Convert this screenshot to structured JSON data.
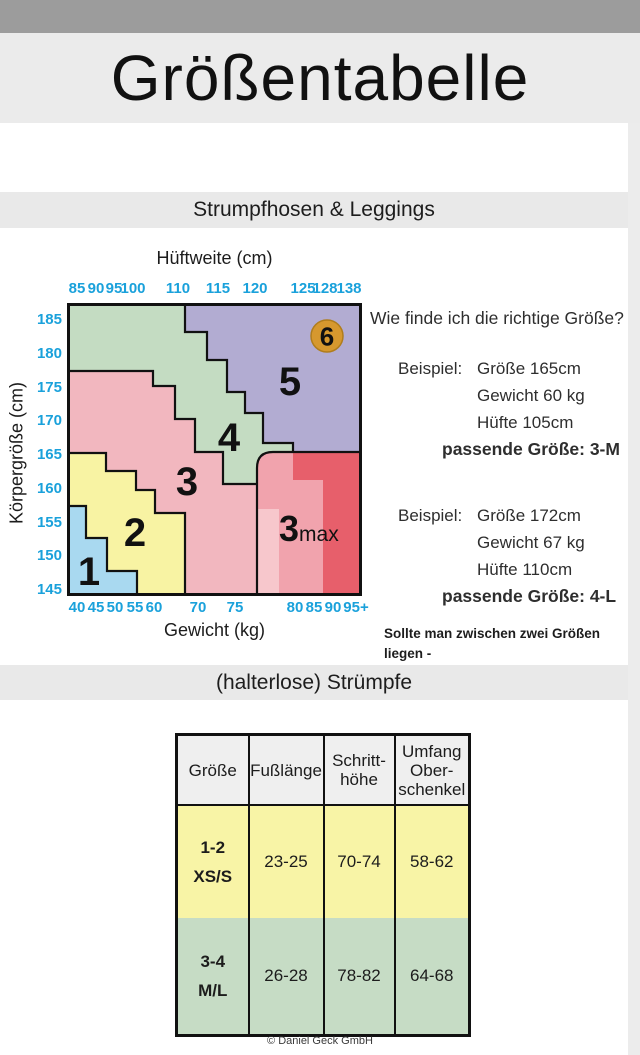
{
  "page": {
    "title": "Größentabelle",
    "footer": "© Daniel Geck GmbH"
  },
  "sections": {
    "tights": "Strumpfhosen & Leggings",
    "stockings": "(halterlose) Strümpfe"
  },
  "help": {
    "question": "Wie finde ich die richtige Größe?",
    "examples": [
      {
        "label": "Beispiel:",
        "lines": [
          "Größe 165cm",
          "Gewicht 60 kg",
          "Hüfte 105cm"
        ],
        "result": "passende Größe: 3-M"
      },
      {
        "label": "Beispiel:",
        "lines": [
          "Größe 172cm",
          "Gewicht 67 kg",
          "Hüfte 110cm"
        ],
        "result": "passende Größe: 4-L"
      }
    ],
    "note": "Sollte man zwischen zwei Größen liegen -\nimmer die nächstgrößere Größe wählen."
  },
  "chart_data": {
    "type": "heatmap",
    "title": "Strumpfhosen & Leggings Größenfinder",
    "x_top": {
      "label": "Hüftweite (cm)",
      "ticks": [
        "85",
        "90",
        "95",
        "100",
        "110",
        "115",
        "120",
        "125",
        "128",
        "138"
      ]
    },
    "x_bottom": {
      "label": "Gewicht (kg)",
      "ticks": [
        "40",
        "45",
        "50",
        "55",
        "60",
        "70",
        "75",
        "80",
        "85",
        "90",
        "95+"
      ]
    },
    "y": {
      "label": "Körpergröße (cm)",
      "ticks": [
        "185",
        "180",
        "175",
        "170",
        "165",
        "160",
        "155",
        "150",
        "145"
      ]
    },
    "grid": false,
    "regions": [
      {
        "label": "1",
        "color": "#a9d9f0",
        "area": "unten links: Gewicht ca. 40–60 kg, Körpergröße ca. 145–157 cm"
      },
      {
        "label": "2",
        "color": "#f8f3a3",
        "area": "Gewicht ca. 40–67 kg, Körpergröße ca. 145–165 cm"
      },
      {
        "label": "3",
        "color": "#f2b7bf",
        "area": "Mitte: Gewicht ca. 50–77 kg, Körpergröße ca. 145–178 cm"
      },
      {
        "label": "4",
        "color": "#c4dcc2",
        "area": "Diagonalband: Hüftweite ca. 100–120 cm, Körpergröße bis 188 cm"
      },
      {
        "label": "5",
        "color": "#b2acd2",
        "area": "oben rechts: Hüftweite ca. 110–138 cm, Körpergröße ca. 165–188 cm"
      },
      {
        "label": "6",
        "color": "#d6982e",
        "area": "Kreis oben rechts: Hüftweite ca. 128–138 cm, Körpergröße ca. 180–185 cm"
      },
      {
        "label_bold": "3",
        "label_suffix": "max",
        "colors": [
          "#f1a3ad",
          "#f7c7cc",
          "#e75f6b"
        ],
        "area": "unten rechts: Gewicht ca. 77–95+ kg, Körpergröße ca. 145–165 cm"
      }
    ]
  },
  "stockings_table": {
    "headers": [
      "Größe",
      "Fußlänge",
      "Schritt-\nhöhe",
      "Umfang\nOber-\nschenkel"
    ],
    "rows": [
      {
        "size": "1-2\nXS/S",
        "fusslaenge": "23-25",
        "schritthoehe": "70-74",
        "umfang": "58-62",
        "color": "#f8f4a6"
      },
      {
        "size": "3-4\nM/L",
        "fusslaenge": "26-28",
        "schritthoehe": "78-82",
        "umfang": "64-68",
        "color": "#c6dcc5"
      }
    ]
  },
  "colors": {
    "top_bar": "#9c9c9c",
    "band_gray": "#e9e9e9",
    "tick_blue": "#1aa1db",
    "border_black": "#111111"
  }
}
